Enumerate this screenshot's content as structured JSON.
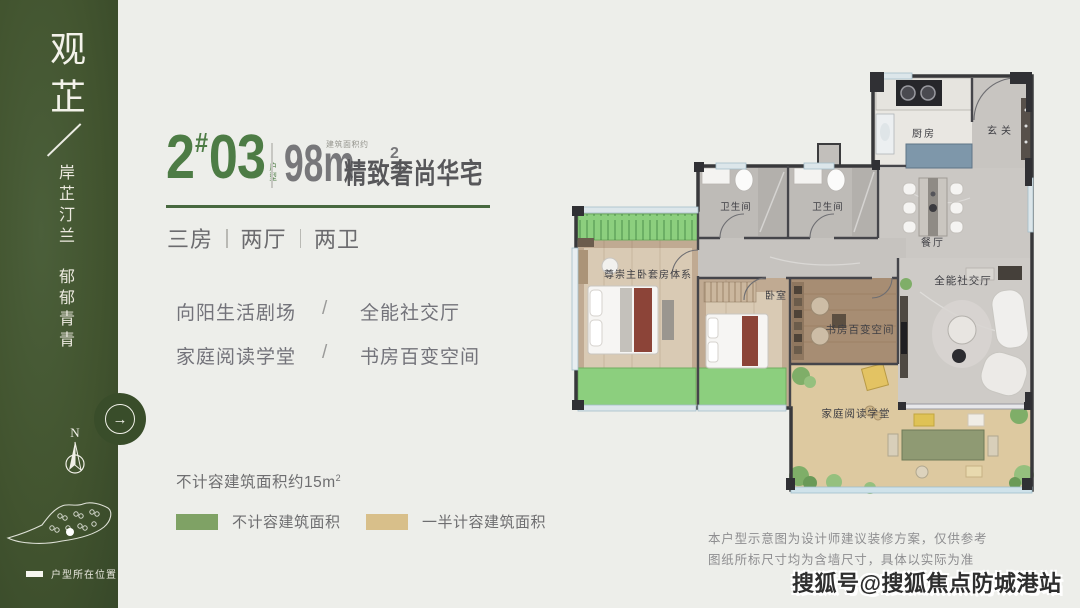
{
  "colors": {
    "sidebar_green": "#42542f",
    "accent_green": "#4d7c45",
    "rule_green": "#47683f",
    "text_dark": "#57575a",
    "text_gray": "#6e6e70",
    "page_bg": "#edeeea",
    "plan_balcony_green": "#8ccf7e",
    "plan_terrace_tan": "#ddc9a0"
  },
  "sidebar": {
    "brand": "观芷",
    "slogan1": "岸芷汀兰",
    "slogan2": "郁郁青青",
    "compass_n": "N",
    "map_marker_label": "户型所在位置"
  },
  "header": {
    "block_no": "2",
    "hash": "#",
    "unit_no": "03",
    "unit_type_label": "户型",
    "area_prefix_small": "建筑面积约",
    "area_number": "98m",
    "area_sup": "2",
    "tagline": "精致奢尚华宅"
  },
  "layout_spec": {
    "items": [
      "三房",
      "两厅",
      "两卫"
    ]
  },
  "features": {
    "rows": [
      {
        "left": "向阳生活剧场",
        "slash": "/",
        "right": "全能社交厅"
      },
      {
        "left": "家庭阅读学堂",
        "slash": "/",
        "right": "书房百变空间"
      }
    ]
  },
  "area_note": {
    "text": "不计容建筑面积约15m",
    "sup": "2"
  },
  "legend": {
    "items": [
      {
        "label": "不计容建筑面积",
        "color": "#7fa265"
      },
      {
        "label": "一半计容建筑面积",
        "color": "#d8bf8a"
      }
    ]
  },
  "floorplan": {
    "rooms": {
      "kitchen": "厨房",
      "entry": "玄关",
      "bath1": "卫生间",
      "bath2": "卫生间",
      "dining": "餐厅",
      "master": "尊崇主卧套房体系",
      "bedroom": "卧室",
      "study": "书房百变空间",
      "living": "全能社交厅",
      "terrace": "家庭阅读学堂"
    }
  },
  "disclaimer": {
    "line1": "本户型示意图为设计师建议装修方案，仅供参考",
    "line2": "图纸所标尺寸均为含墙尺寸，具体以实际为准"
  },
  "watermark": "搜狐号@搜狐焦点防城港站"
}
